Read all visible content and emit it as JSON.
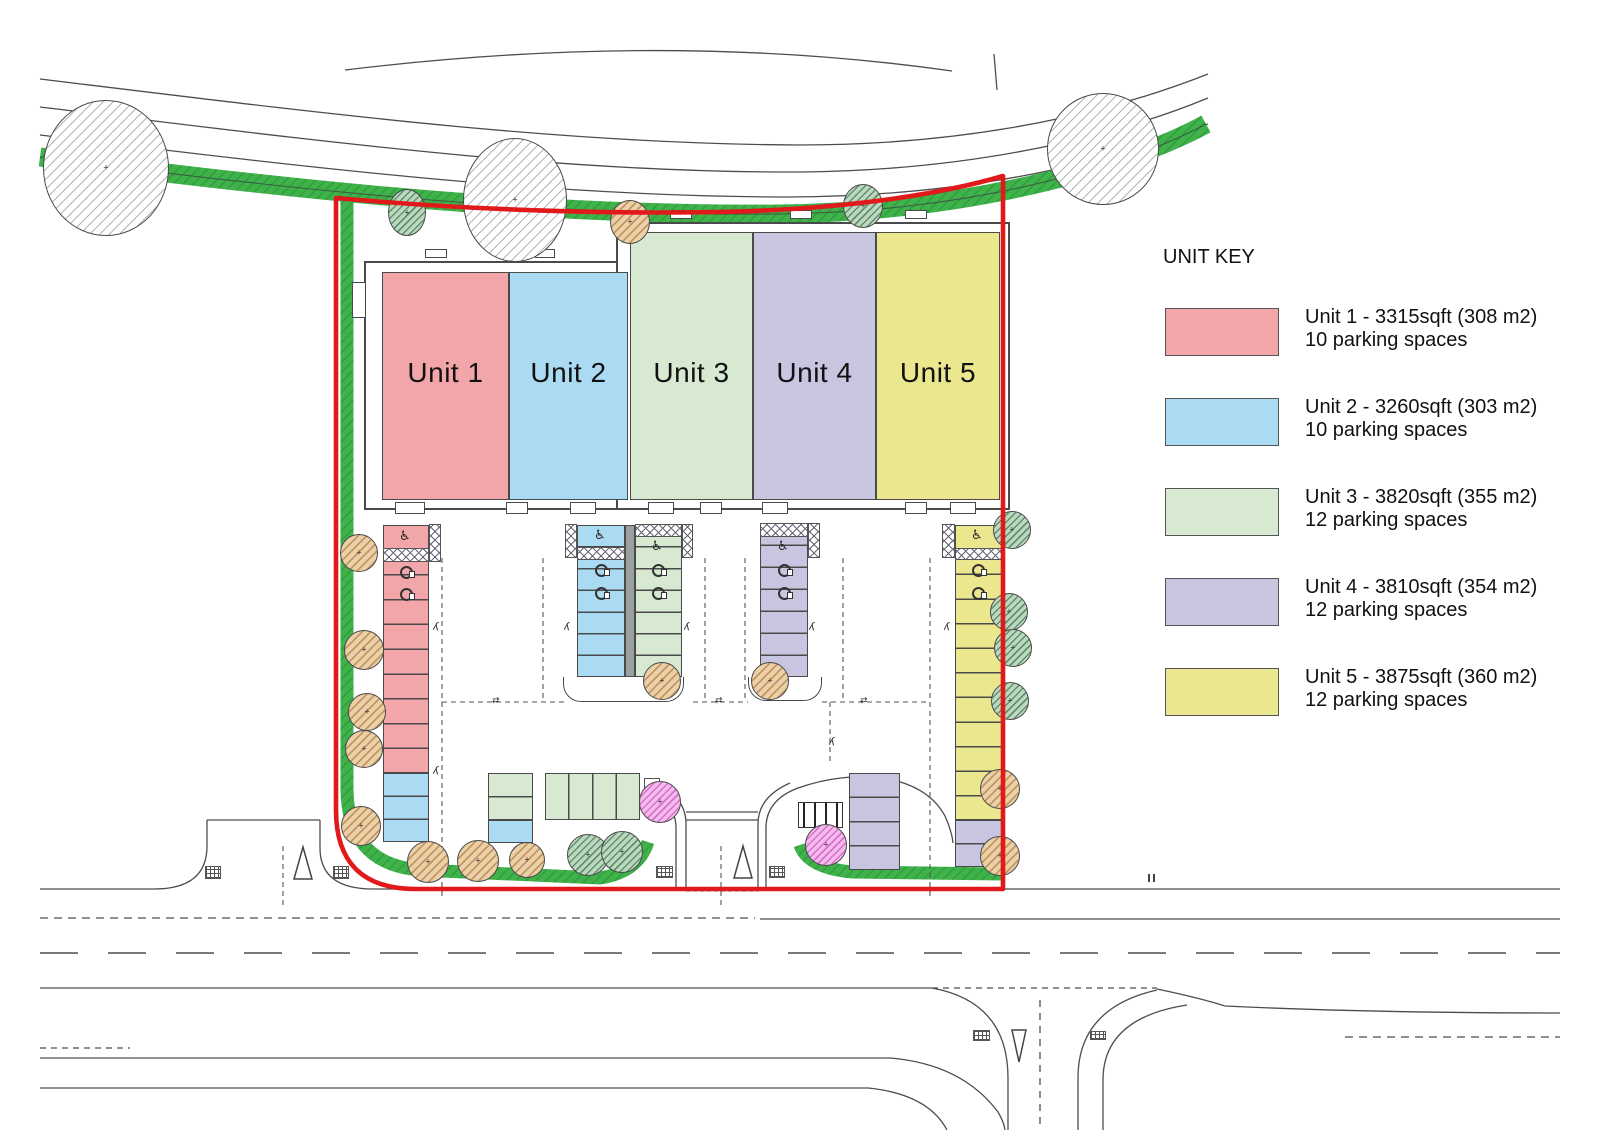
{
  "legend": {
    "title": "UNIT KEY",
    "entries": [
      {
        "label": "Unit 1",
        "line1": "Unit 1 - 3315sqft (308 m2)",
        "line2": "10 parking spaces",
        "color": "#f2a6a9"
      },
      {
        "label": "Unit 2",
        "line1": "Unit 2 - 3260sqft (303 m2)",
        "line2": "10 parking spaces",
        "color": "#abdbf3"
      },
      {
        "label": "Unit 3",
        "line1": "Unit 3 - 3820sqft (355 m2)",
        "line2": "12 parking spaces",
        "color": "#d7e9d1"
      },
      {
        "label": "Unit 4",
        "line1": "Unit 4 - 3810sqft (354 m2)",
        "line2": "12 parking spaces",
        "color": "#c8c5e0"
      },
      {
        "label": "Unit 5",
        "line1": "Unit 5 - 3875sqft (360 m2)",
        "line2": "12 parking spaces",
        "color": "#eae78f"
      }
    ]
  },
  "site": {
    "boundary_color": "#e2191b",
    "landscape_color": "#3fb24a"
  }
}
